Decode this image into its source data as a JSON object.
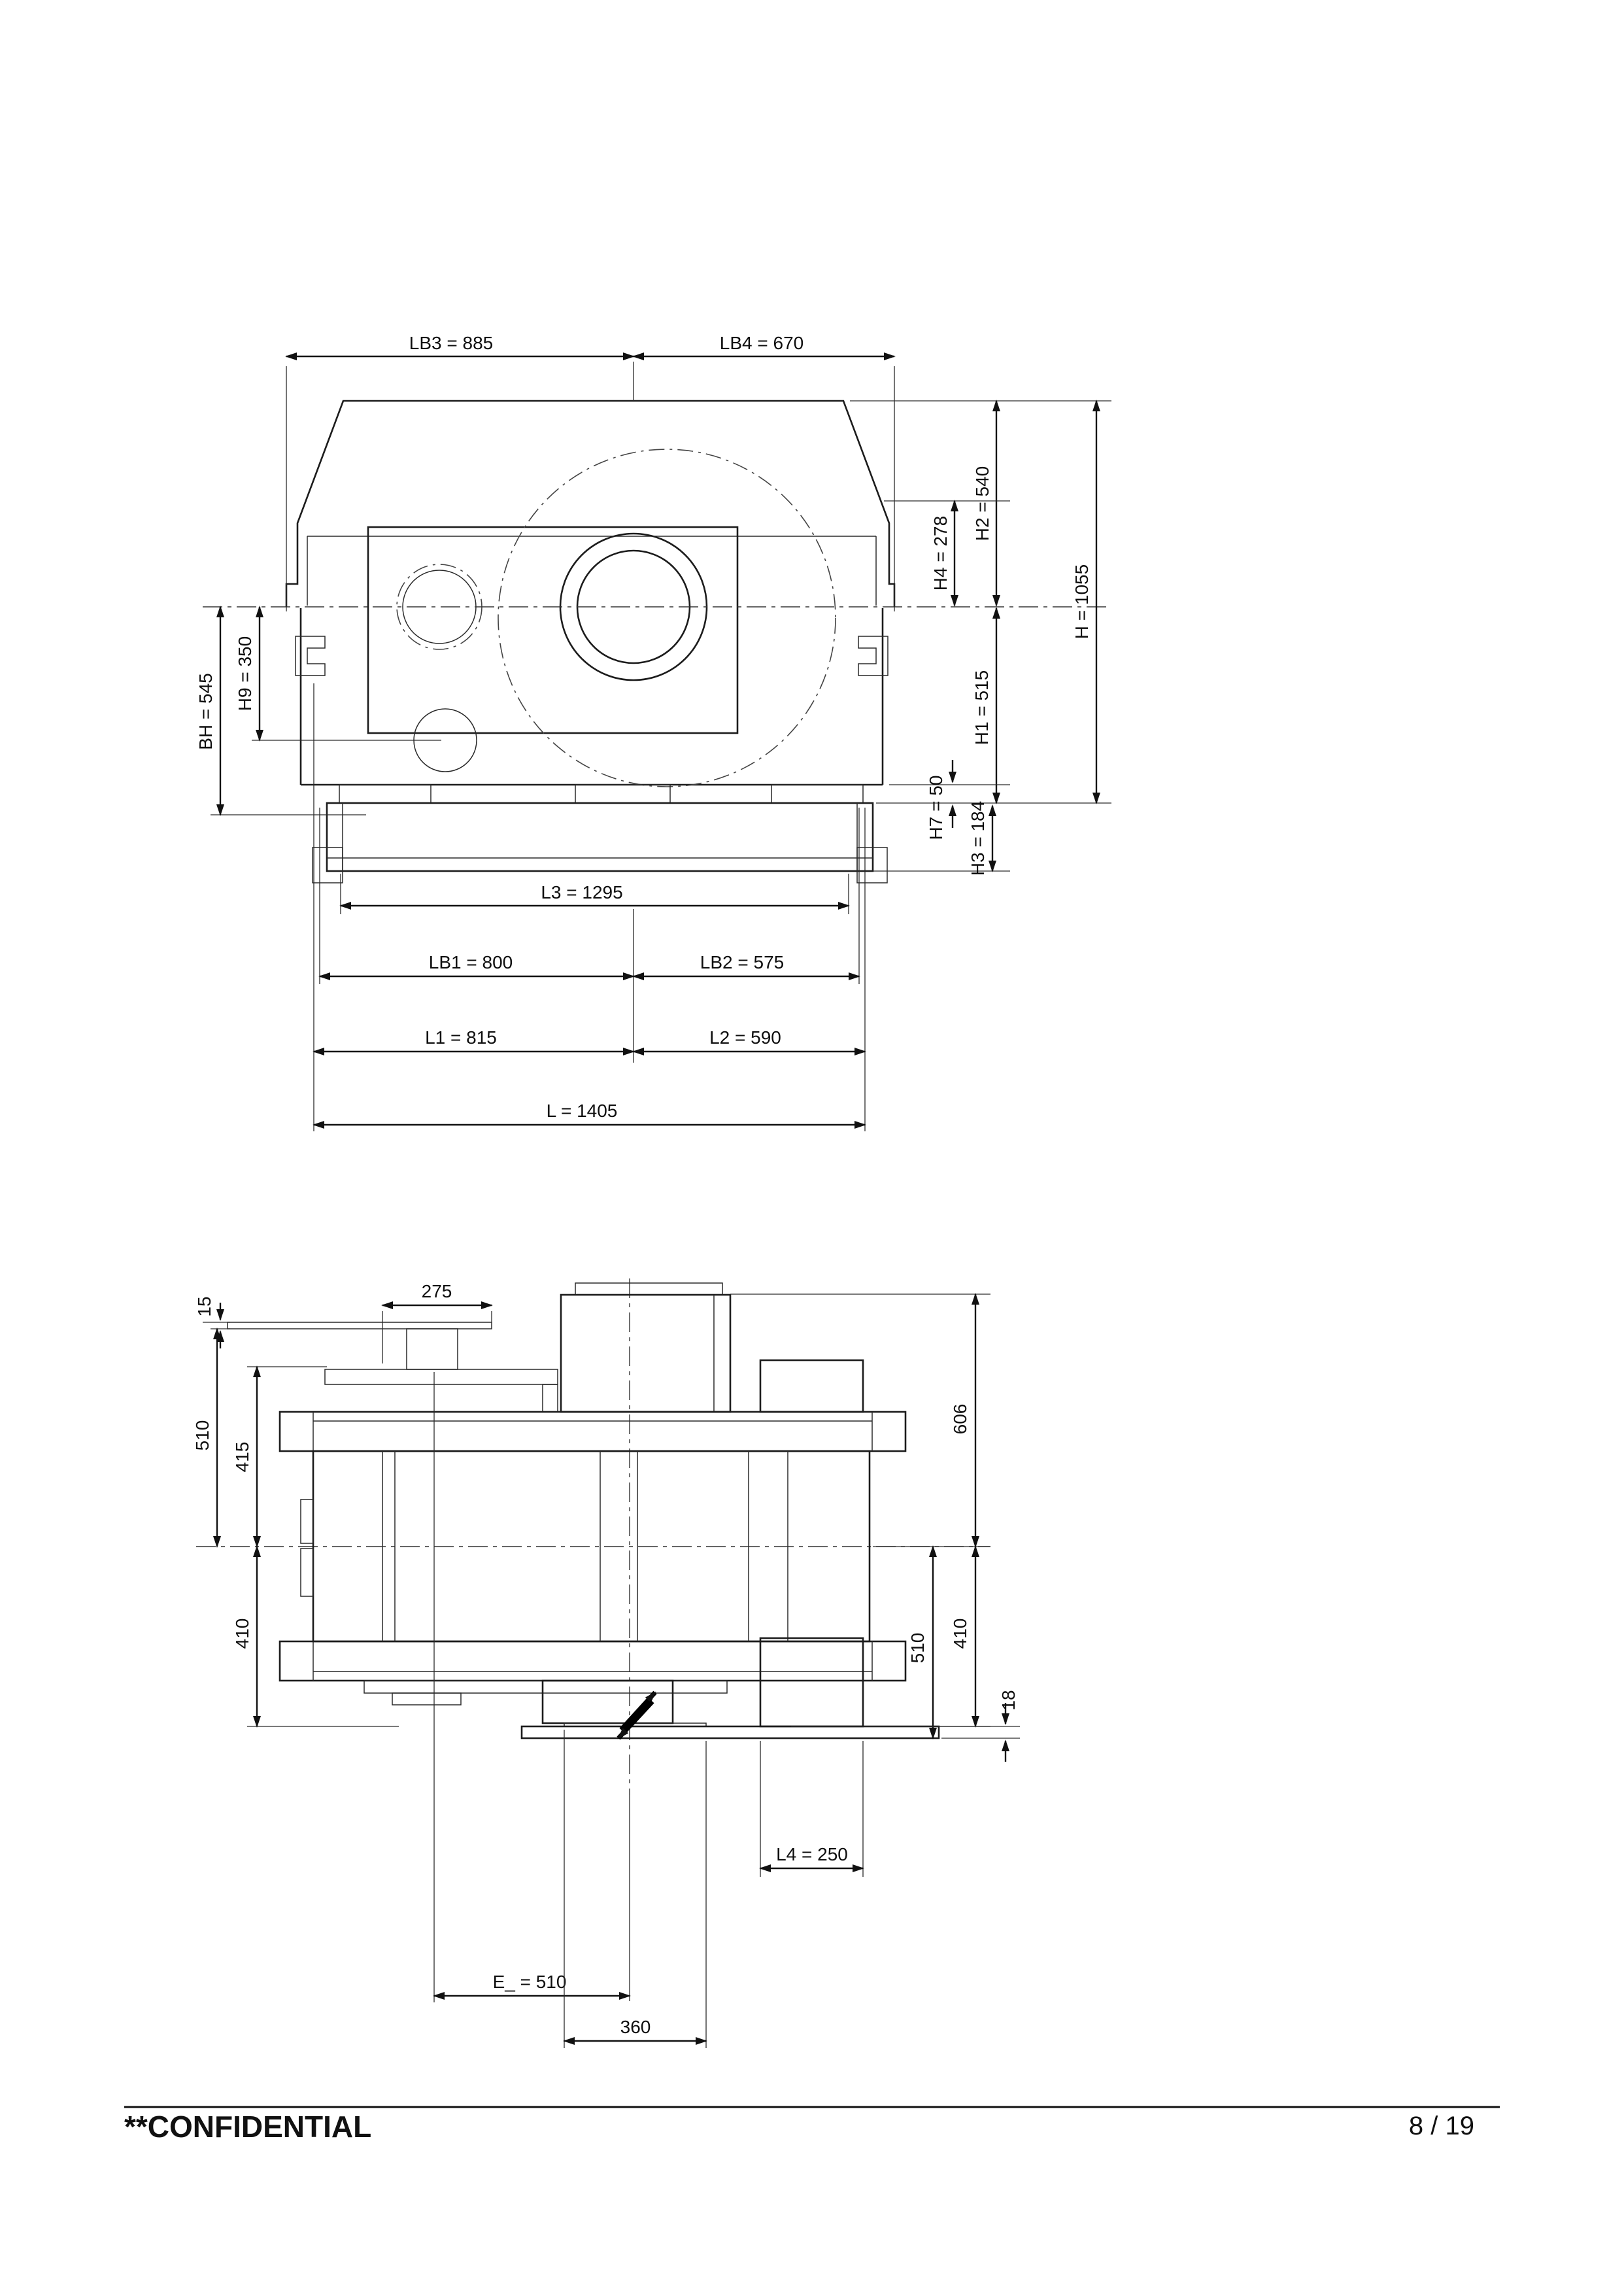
{
  "page": {
    "background": "#ffffff",
    "ink": "#1c1c1c"
  },
  "front_view": {
    "title": "gearbox-front-elevation",
    "dims": {
      "lb3": "LB3 = 885",
      "lb4": "LB4 = 670",
      "h2": "H2 = 540",
      "h4": "H4 = 278",
      "h": "H = 1055",
      "h1": "H1 = 515",
      "h7": "H7 = 50",
      "h3": "H3 = 184",
      "bh": "BH = 545",
      "h9": "H9 = 350",
      "l3": "L3 = 1295",
      "lb1": "LB1 = 800",
      "lb2": "LB2 = 575",
      "l1": "L1 = 815",
      "l2": "L2 = 590",
      "l": "L = 1405"
    }
  },
  "plan_view": {
    "title": "gearbox-plan-view",
    "dims": {
      "p275": "275",
      "p15": "15",
      "p510l": "510",
      "p415": "415",
      "p410l": "410",
      "p606": "606",
      "p410r": "410",
      "p510r": "510",
      "p18": "18",
      "l4": "L4 = 250",
      "e": "E_ = 510",
      "p360": "360"
    }
  },
  "footer": {
    "confidential": "**CONFIDENTIAL",
    "page_number": "8 / 19"
  }
}
